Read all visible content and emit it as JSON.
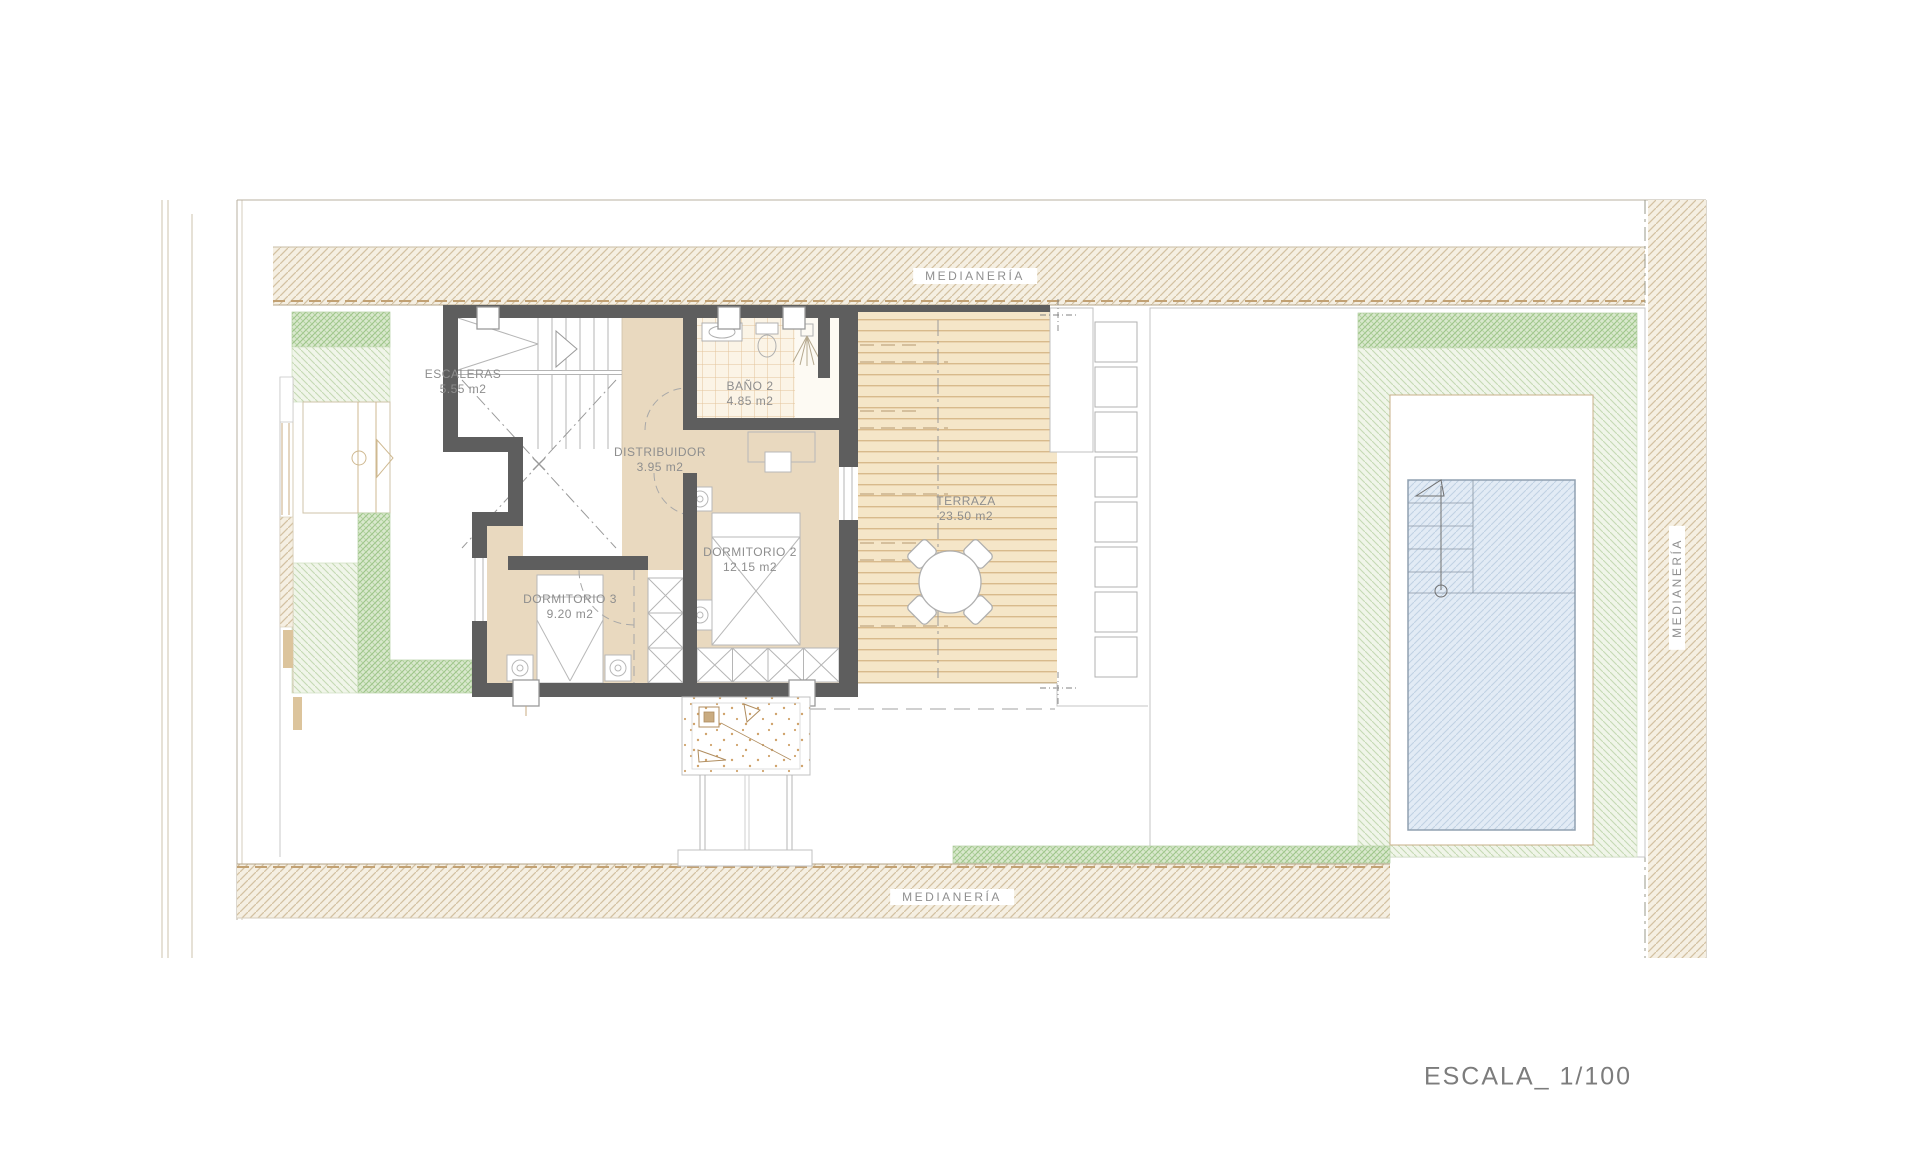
{
  "drawing": {
    "scale_label": "ESCALA_ 1/100",
    "party_wall_labels": {
      "top": "MEDIANERÍA",
      "bottom": "MEDIANERÍA",
      "right": "MEDIANERÍA"
    },
    "rooms": [
      {
        "name": "ESCALERAS",
        "area": "5.55 m2"
      },
      {
        "name": "BAÑO 2",
        "area": "4.85 m2"
      },
      {
        "name": "DISTRIBUIDOR",
        "area": "3.95 m2"
      },
      {
        "name": "DORMITORIO 2",
        "area": "12.15 m2"
      },
      {
        "name": "DORMITORIO 3",
        "area": "9.20 m2"
      },
      {
        "name": "TERRAZA",
        "area": "23.50 m2"
      }
    ],
    "colors": {
      "wall": "#5e5e5e",
      "room_floor": "#e9d9bf",
      "deck": "#f5e6c8",
      "hatch_band_line": "#d4c2a2",
      "green_dark": "#9cc488",
      "green_light": "#c2d9b2",
      "pool_fill": "#e2ebf5",
      "label_text": "#8e8e8e"
    }
  }
}
